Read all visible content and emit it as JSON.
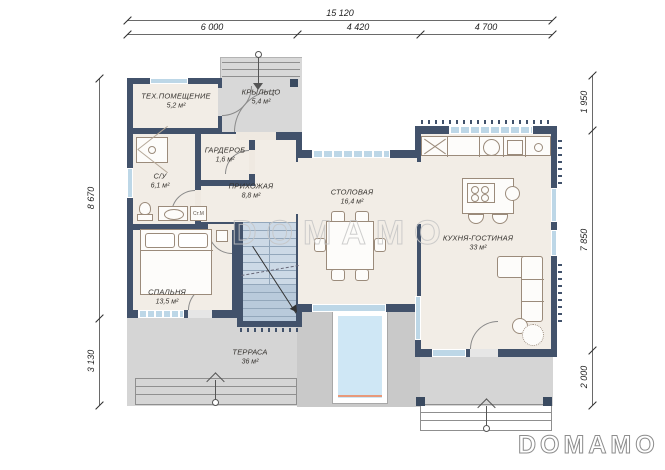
{
  "brand": {
    "logo": "DOMAMO",
    "watermark": "DOMAMO"
  },
  "dimensions": {
    "top_total": "15 120",
    "top_segments": [
      "6 000",
      "4 420",
      "4 700"
    ],
    "left": [
      "8 670",
      "3 130"
    ],
    "right": [
      "1 950",
      "7 850",
      "2 000"
    ]
  },
  "rooms": [
    {
      "name": "ТЕХ.ПОМЕЩЕНИЕ",
      "area": "5,2 м²"
    },
    {
      "name": "КРЫЛЬЦО",
      "area": "5,4 м²"
    },
    {
      "name": "ГАРДЕРОБ",
      "area": "1,6 м²"
    },
    {
      "name": "С/У",
      "area": "6,1 м²"
    },
    {
      "name": "ПРИХОЖАЯ",
      "area": "8,8 м²"
    },
    {
      "name": "СТОЛОВАЯ",
      "area": "16,4 м²"
    },
    {
      "name": "КУХНЯ-ГОСТИНАЯ",
      "area": "33 м²"
    },
    {
      "name": "СПАЛЬНЯ",
      "area": "13,5 м²"
    },
    {
      "name": "ТЕРРАСА",
      "area": "36 м²"
    }
  ],
  "labels": {
    "washing_machine": "Ст.М"
  },
  "colors": {
    "wall": "#42526b",
    "room_fill": "#f2ede6",
    "terrace": "#d5d5d5",
    "stairs": "#ccd9e6",
    "window": "#bdd7e7",
    "pool": "#cfe7f5",
    "pool_accent": "#e8997a"
  }
}
